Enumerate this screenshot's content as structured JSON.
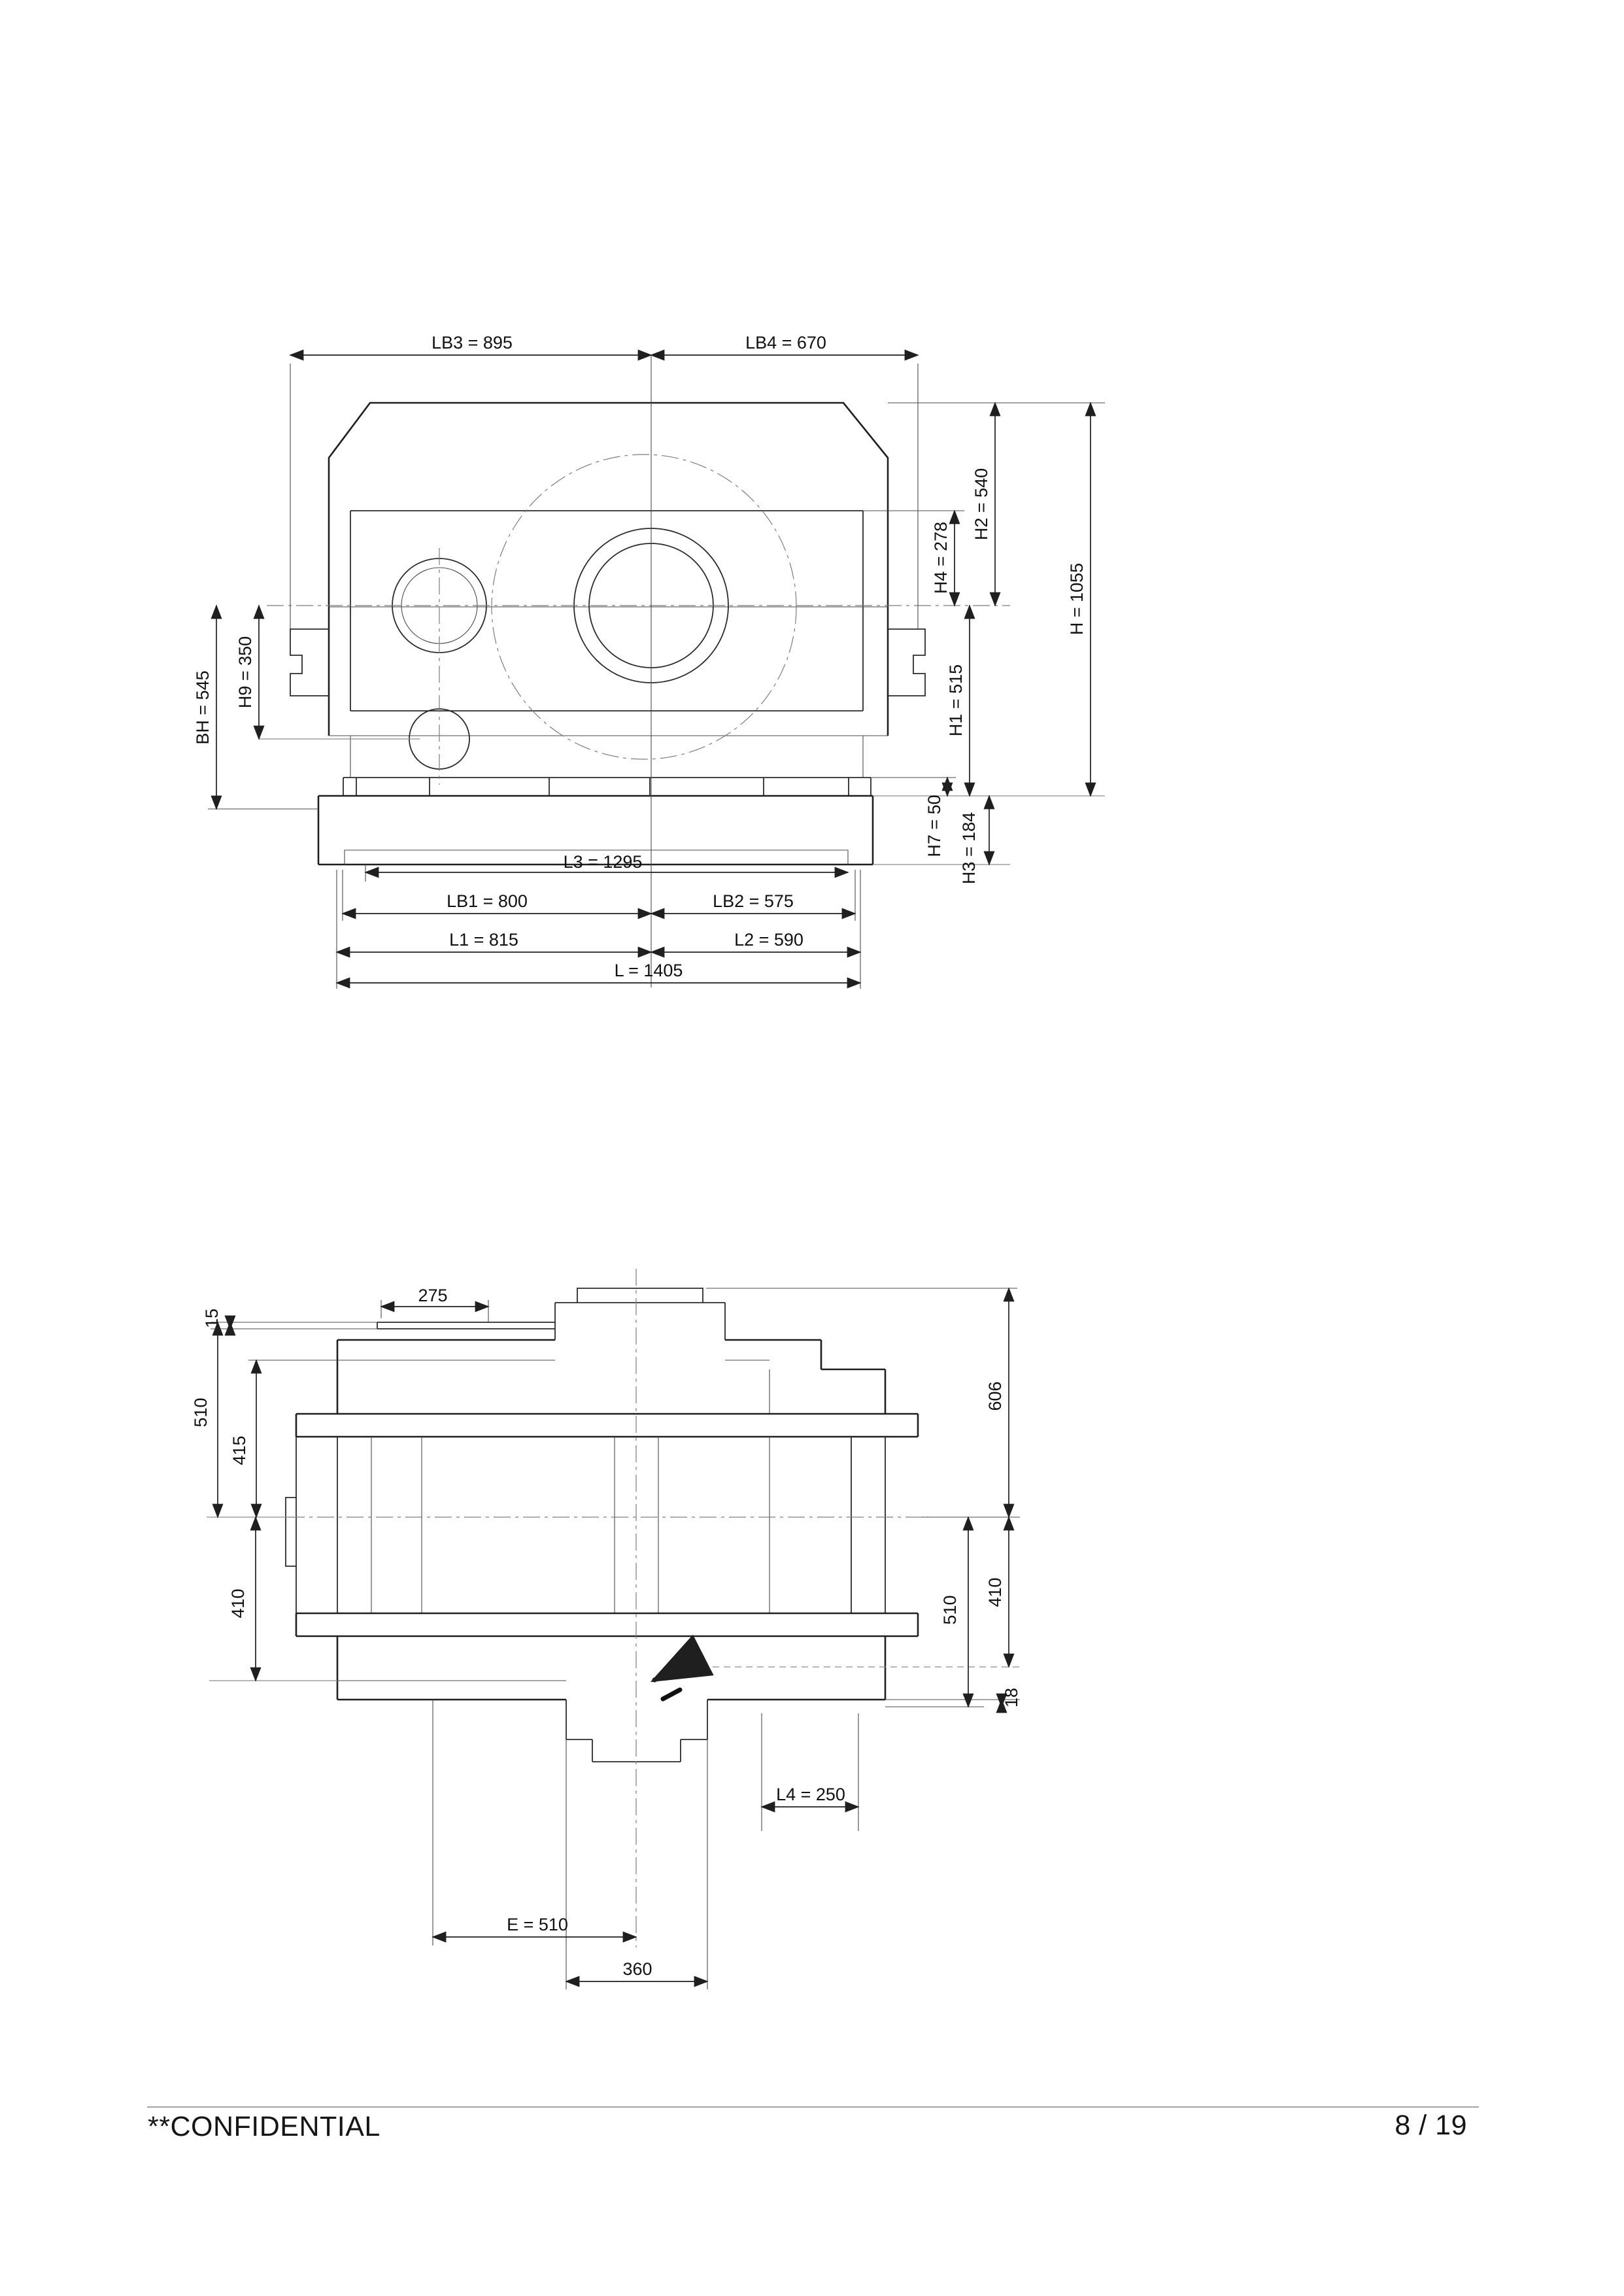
{
  "page": {
    "background": "#ffffff",
    "footer": {
      "confidential": "**CONFIDENTIAL",
      "page_number": "8 / 19"
    }
  },
  "front_view": {
    "description": "gear-unit front elevation",
    "dims": {
      "lb3": "LB3 = 895",
      "lb4": "LB4 = 670",
      "h2": "H2 = 540",
      "h4": "H4 = 278",
      "h": "H = 1055",
      "h1": "H1 = 515",
      "h7": "H7 = 50",
      "h3": "H3 = 184",
      "bh": "BH = 545",
      "h9": "H9 = 350",
      "l3": "L3 = 1295",
      "lb1": "LB1 = 800",
      "lb2": "LB2 = 575",
      "l1": "L1 = 815",
      "l2": "L2 = 590",
      "l": "L = 1405"
    }
  },
  "plan_view": {
    "description": "gear-unit plan view",
    "dims": {
      "top_275": "275",
      "flange_15": "15",
      "left_510": "510",
      "left_415": "415",
      "left_410": "410",
      "right_606": "606",
      "right_410": "410",
      "right_510": "510",
      "right_18": "18",
      "l4": "L4 = 250",
      "e": "E = 510",
      "width_360": "360"
    }
  }
}
